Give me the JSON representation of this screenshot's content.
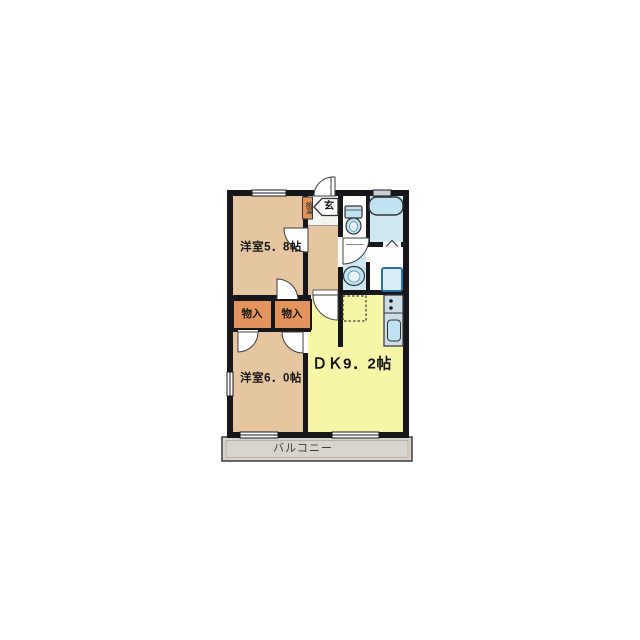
{
  "floorplan": {
    "labels": {
      "bedroom1": "洋室5．8帖",
      "bedroom2": "洋室6．0帖",
      "dining_kitchen": "ＤＫ9．2帖",
      "closet_left": "物入",
      "closet_right": "物入",
      "entrance": "玄",
      "water_heater": "給湯",
      "balcony": "バルコニー"
    },
    "colors": {
      "wall": "#17171b",
      "room_floor_tan": "#e6c6a1",
      "closet_orange": "#e2945c",
      "dk_floor_yellow": "#f7f6a6",
      "wet_area_blue": "#cfe9f4",
      "fixture_blue": "#bfe3f2",
      "kitchen_counter_grey": "#ccdde8",
      "balcony_grey": "#d9d4cb",
      "background": "#ffffff"
    },
    "fixtures": [
      "toilet",
      "bathtub",
      "washbasin",
      "washing-machine-space",
      "kitchen-counter",
      "stove-burners",
      "kitchen-sink",
      "refrigerator-space",
      "water-heater",
      "entrance-arrow"
    ]
  }
}
